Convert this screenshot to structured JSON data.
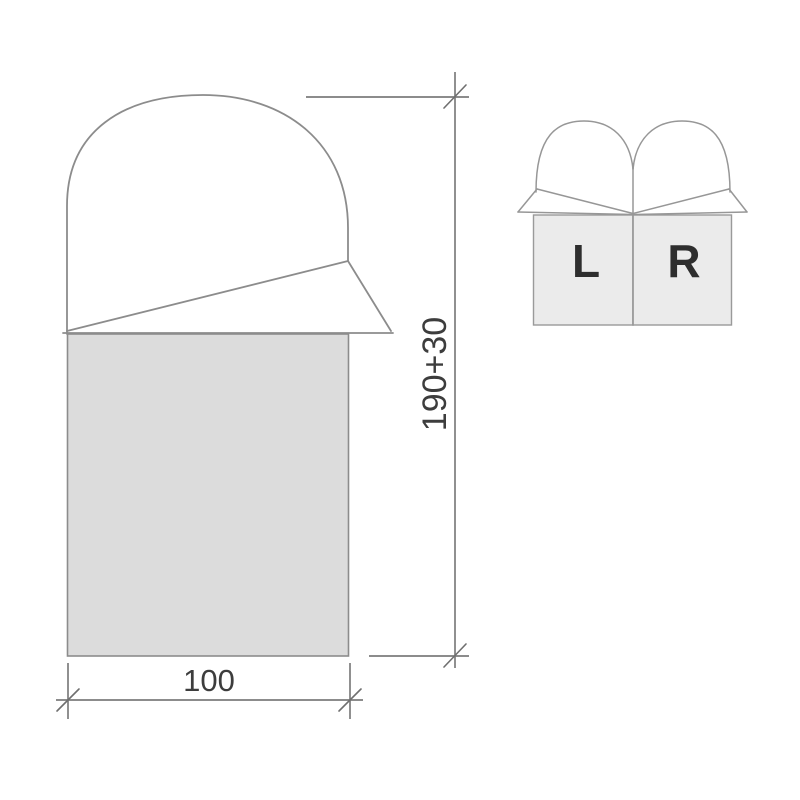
{
  "diagram": {
    "main_bag": {
      "height_dimension_label": "190+30",
      "width_dimension_label": "100"
    },
    "pair_bags": {
      "left_label": "L",
      "right_label": "R"
    }
  },
  "colors": {
    "background": "#ffffff",
    "outline": "#8c8c8c",
    "dimension_line": "#7c7c7c",
    "main_bag_fill": "#dcdcdc",
    "pair_bag_fill": "#ebebeb",
    "dimension_text": "#3d3d3d",
    "lr_label_text": "#2e2e2e"
  }
}
